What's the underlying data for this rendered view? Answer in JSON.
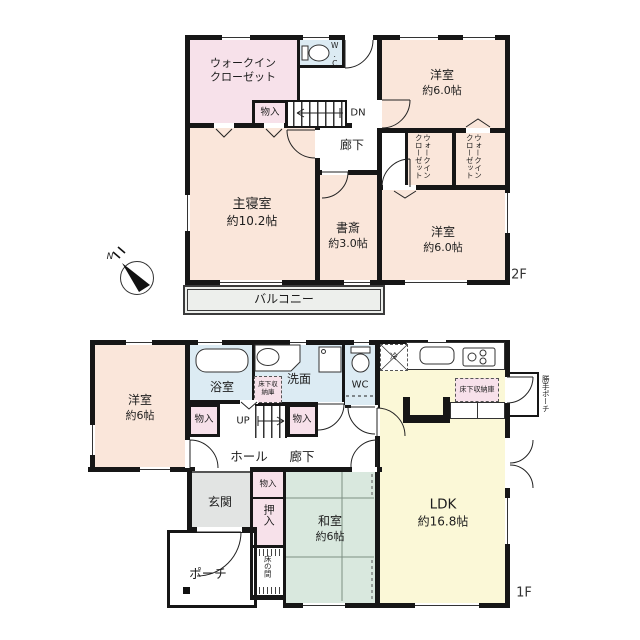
{
  "colors": {
    "room_peach": "#fae6da",
    "closet_pink": "#f7e1ea",
    "wet_blue": "#dcebf3",
    "ldk_yellow": "#fbf8d7",
    "washitsu_green": "#d9e8de",
    "genkan_gray": "#e2e4e3",
    "balcony_gray": "#edefec",
    "wall": "#161616"
  },
  "compass": {
    "n": "N"
  },
  "f2": {
    "label": "2F",
    "wic": {
      "l1": "ウォークイン",
      "l2": "クローゼット"
    },
    "wc": "W.C",
    "monoiri": "物入",
    "dn": "DN",
    "rouka": "廊下",
    "yoshitsu_n": {
      "name": "洋室",
      "size": "約6.0帖"
    },
    "wic1": {
      "l1": "ウォークイン",
      "l2": "クローゼット"
    },
    "wic2": {
      "l1": "ウォークイン",
      "l2": "クローゼット"
    },
    "shinshitsu": {
      "name": "主寝室",
      "size": "約10.2帖"
    },
    "shosai": {
      "name": "書斎",
      "size": "約3.0帖"
    },
    "yoshitsu_s": {
      "name": "洋室",
      "size": "約6.0帖"
    },
    "balcony": "バルコニー"
  },
  "f1": {
    "label": "1F",
    "yoshitsu": {
      "name": "洋室",
      "size": "約6帖"
    },
    "yokushitsu": "浴室",
    "senmen": "洗面",
    "wc": "WC",
    "rei": "冷",
    "yukashita1": "床下収納庫",
    "yukashita2": "床下収納庫",
    "katte_porch": "勝手ポーチ",
    "monoiri_w": "物入",
    "monoiri_e": "物入",
    "up": "UP",
    "hall": "ホール",
    "rouka": "廊下",
    "genkan": "玄関",
    "porch": "ポーチ",
    "monoiri_s": "物入",
    "oshiire": "押入",
    "tokonoma": "床の間",
    "washitsu": {
      "name": "和室",
      "size": "約6帖"
    },
    "ldk": {
      "name": "LDK",
      "size": "約16.8帖"
    }
  }
}
